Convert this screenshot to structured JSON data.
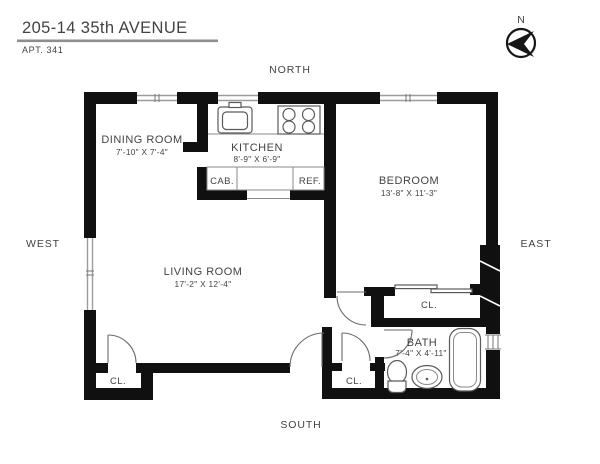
{
  "header": {
    "address": "205-14 35th AVENUE",
    "apt": "APT. 341"
  },
  "compass": {
    "north_abbrev": "N"
  },
  "orientation": {
    "north": "NORTH",
    "south": "SOUTH",
    "east": "EAST",
    "west": "WEST"
  },
  "rooms": {
    "dining": {
      "name": "DINING ROOM",
      "dims": "7'-10\" X 7'-4\""
    },
    "kitchen": {
      "name": "KITCHEN",
      "dims": "8'-9\" X 6'-9\""
    },
    "bedroom": {
      "name": "BEDROOM",
      "dims": "13'-8\" X 11'-3\""
    },
    "living": {
      "name": "LIVING ROOM",
      "dims": "17'-2\" X 12'-4\""
    },
    "bath": {
      "name": "BATH",
      "dims": "7'-4\" X 4'-11\""
    }
  },
  "fixtures": {
    "cabinet": "CAB.",
    "refrigerator": "REF."
  },
  "closets": {
    "bedroom_closet": "CL.",
    "hall_closet": "CL.",
    "living_closet": "CL."
  },
  "colors": {
    "wall": "#101010",
    "fixture_line": "#5a5a5a",
    "window_line": "#9c9c9c",
    "text": "#434343",
    "background": "#ffffff"
  }
}
